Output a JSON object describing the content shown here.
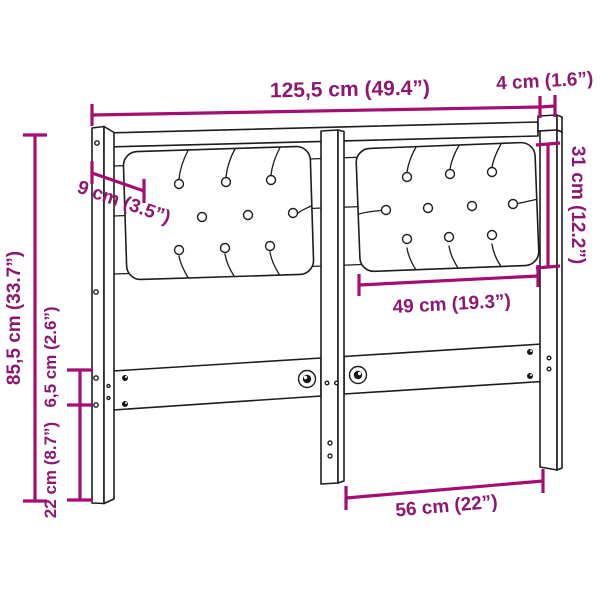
{
  "diagram": {
    "kind": "headboard-dimension-diagram",
    "background": "#ffffff",
    "accent_color": "#A40E70",
    "text_color": "#8E176F",
    "outline_color": "#1d1d1d",
    "dimensions": {
      "total_width": "125,5 cm (49.4”)",
      "frame_depth": "4 cm (1.6”)",
      "cushion_height": "31 cm (12.2”)",
      "post_width": "9 cm (3.5”)",
      "cushion_width": "49 cm (19.3”)",
      "total_height": "85,5 cm (33.7”)",
      "rail_height": "6,5 cm (2.6”)",
      "leg_height": "22 cm (8.7”)",
      "leg_span": "56 cm (22”)"
    }
  }
}
